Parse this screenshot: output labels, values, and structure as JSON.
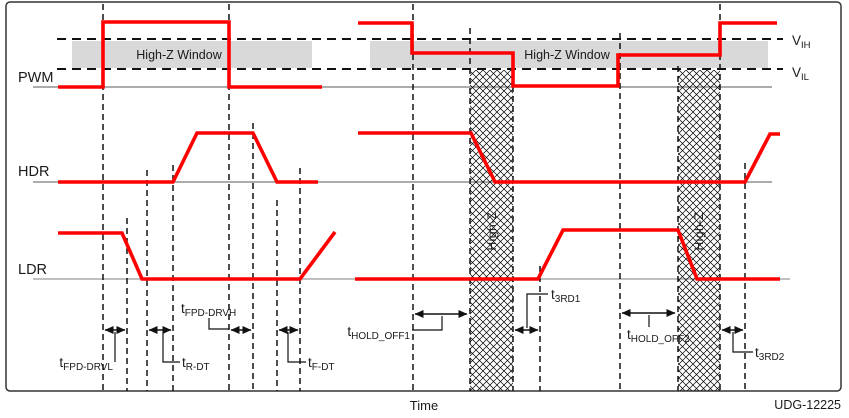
{
  "figure": {
    "time_axis_label": "Time",
    "doc_id": "UDG-12225"
  },
  "signal_labels": {
    "pwm": "PWM",
    "hdr": "HDR",
    "ldr": "LDR"
  },
  "thresholds": {
    "vih": {
      "main": "V",
      "sub": "IH"
    },
    "vil": {
      "main": "V",
      "sub": "IL"
    }
  },
  "highz": {
    "window_label_left": "High-Z Window",
    "window_label_right": "High-Z Window",
    "bar_label_1": "High-Z",
    "bar_label_2": "High-Z"
  },
  "timings": {
    "tfpd_drvl": {
      "main": "t",
      "sub": "FPD-DRVL"
    },
    "tr_dt": {
      "main": "t",
      "sub": "R-DT"
    },
    "tfpd_drvh": {
      "main": "t",
      "sub": "FPD-DRVH"
    },
    "tf_dt": {
      "main": "t",
      "sub": "F-DT"
    },
    "thold_off1": {
      "main": "t",
      "sub": "HOLD_OFF1"
    },
    "t3rd1": {
      "main": "t",
      "sub": "3RD1"
    },
    "thold_off2": {
      "main": "t",
      "sub": "HOLD_OFF2"
    },
    "t3rd2": {
      "main": "t",
      "sub": "3RD2"
    }
  },
  "colors": {
    "trace": "#ff0000",
    "band_fill": "#d9d9d9",
    "line": "#000000"
  }
}
